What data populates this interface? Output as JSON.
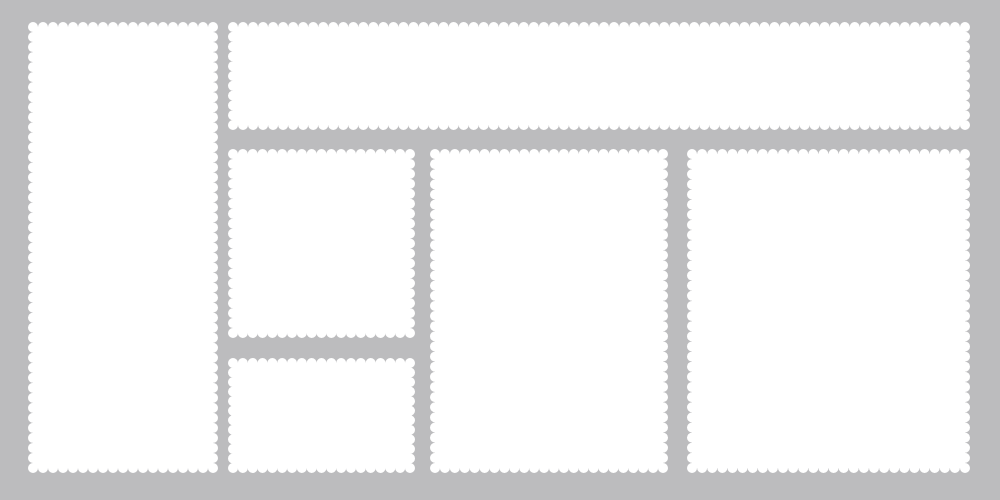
{
  "canvas": {
    "width": 1000,
    "height": 500,
    "background_color": "#bcbcbe",
    "stamp_color": "#ffffff"
  },
  "scallop": {
    "radius": 5,
    "period": 10
  },
  "stamps": [
    {
      "name": "tall-left",
      "x": 33,
      "y": 27,
      "w": 180,
      "h": 441
    },
    {
      "name": "wide-top",
      "x": 233,
      "y": 27,
      "w": 732,
      "h": 98
    },
    {
      "name": "medium-left",
      "x": 233,
      "y": 154,
      "w": 177,
      "h": 179
    },
    {
      "name": "small-bottom-left",
      "x": 233,
      "y": 363,
      "w": 177,
      "h": 105
    },
    {
      "name": "large-center",
      "x": 435,
      "y": 154,
      "w": 228,
      "h": 314
    },
    {
      "name": "large-right",
      "x": 692,
      "y": 154,
      "w": 273,
      "h": 314
    }
  ]
}
